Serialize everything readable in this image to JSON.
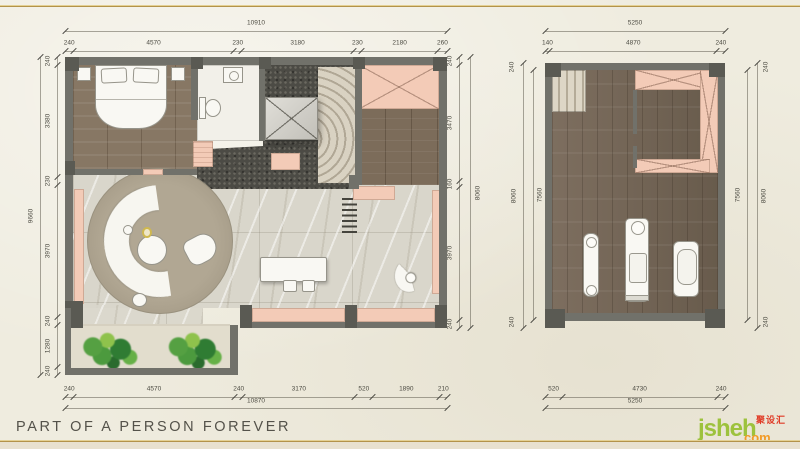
{
  "page": {
    "footer_title": "PART OF A PERSON FOREVER",
    "logo": {
      "main": "jsheh",
      "tld": "com",
      "cn": "聚设汇"
    }
  },
  "colors": {
    "background": "#efecdf",
    "accent_gold": "#b3934a",
    "wall_gray": "#71716a",
    "wall_dark": "#5a5a53",
    "cabinet_pink": "#f3cbb7",
    "wood_brown": "#7c6c5a",
    "marble_light": "#d9d6cb",
    "stair_terrazzo_dark": "#4c4b45",
    "rug_taupe": "#a89e8b",
    "plant_green": "#4f9e40",
    "dim_text": "#4c4b42",
    "footer_text": "#54524a",
    "logo_green": "#9dc23d",
    "logo_orange": "#f29b27",
    "logo_red": "#e03b26"
  },
  "dimensions": {
    "left_plan": {
      "top": {
        "total": "10910",
        "segments": [
          "240",
          "4570",
          "230",
          "3180",
          "230",
          "2180",
          "260"
        ]
      },
      "bottom": {
        "total": "10870",
        "segments": [
          "240",
          "4570",
          "240",
          "3170",
          "520",
          "1890",
          "210"
        ]
      },
      "left": {
        "total": "9660",
        "segments": [
          "240",
          "3380",
          "230",
          "3970",
          "240",
          "1280",
          "240"
        ]
      },
      "right": {
        "total": "8060",
        "segments": [
          "240",
          "3470",
          "160",
          "3970",
          "240"
        ]
      }
    },
    "right_plan": {
      "top": {
        "total": "5250",
        "segments": [
          "140",
          "4870",
          "240"
        ]
      },
      "bottom": {
        "total": "5250",
        "segments": [
          "520",
          "4730",
          "240"
        ]
      },
      "left": {
        "totals": [
          "8060",
          "7560"
        ],
        "end_segments": [
          "240",
          "240"
        ]
      },
      "right": {
        "totals": [
          "7560",
          "8060"
        ],
        "end_segments": [
          "240",
          "240"
        ]
      }
    }
  }
}
